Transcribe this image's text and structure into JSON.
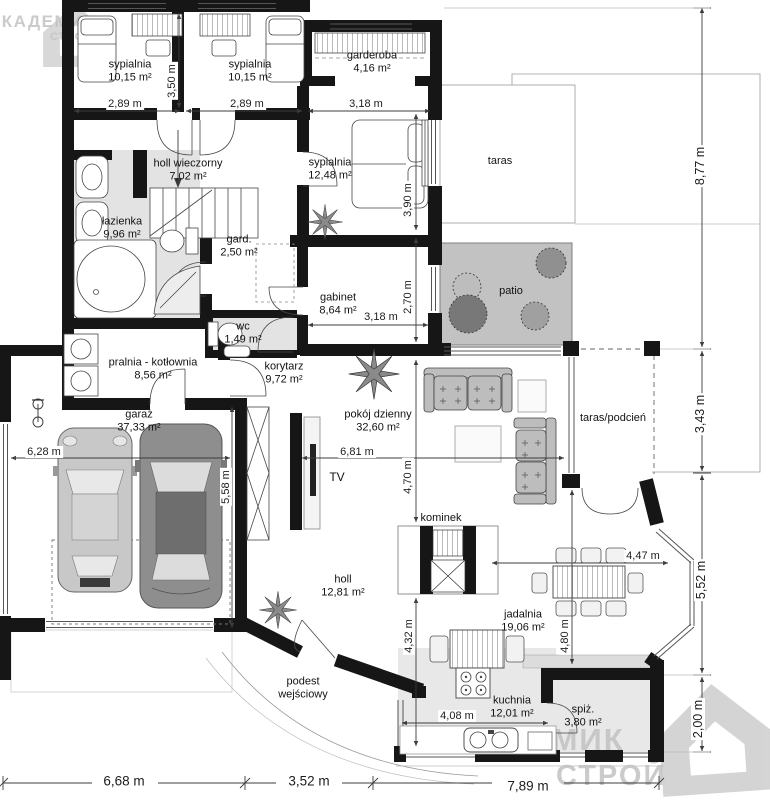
{
  "branding": {
    "watermark_line1": "АКАДЕМИК",
    "watermark_line2": "СТРОЙ"
  },
  "rooms": {
    "sypialnia_lewa": {
      "name": "sypialnia",
      "area": "10,15 m²"
    },
    "sypialnia_prawa": {
      "name": "sypialnia",
      "area": "10,15 m²"
    },
    "garderoba": {
      "name": "garderoba",
      "area": "4,16 m²"
    },
    "sypialnia_glowna": {
      "name": "sypialnia",
      "area": "12,48 m²"
    },
    "holl_wieczorny": {
      "name": "holl wieczorny",
      "area": "7,02 m²"
    },
    "lazienka": {
      "name": "łazienka",
      "area": "9,96 m²"
    },
    "gard": {
      "name": "gard.",
      "area": "2,50 m²"
    },
    "gabinet": {
      "name": "gabinet",
      "area": "8,64 m²"
    },
    "wc": {
      "name": "wc",
      "area": "1,49 m²"
    },
    "pralnia_kotlownia": {
      "name": "pralnia - kotłownia",
      "area": "8,56 m²"
    },
    "korytarz": {
      "name": "korytarz",
      "area": "9,72 m²"
    },
    "garaz": {
      "name": "garaż",
      "area": "37,33 m²"
    },
    "pokoj_dzienny": {
      "name": "pokój dzienny",
      "area": "32,60 m²"
    },
    "holl": {
      "name": "holl",
      "area": "12,81 m²"
    },
    "jadalnia": {
      "name": "jadalnia",
      "area": "19,06 m²"
    },
    "kuchnia": {
      "name": "kuchnia",
      "area": "12,01 m²"
    },
    "spiz": {
      "name": "spiż.",
      "area": "3,80 m²"
    }
  },
  "features": {
    "taras": "taras",
    "patio": "patio",
    "taras_podcien": "taras/podcień",
    "podest_line1": "podest",
    "podest_line2": "wejściowy",
    "kominek": "kominek",
    "tv": "TV"
  },
  "dimensions": {
    "sypialnia_lewa_szer": "2,89 m",
    "sypialnia_prawa_szer": "2,89 m",
    "sypialnie_gleb": "3,50 m",
    "sypialnia_glowna_szer": "3,18 m",
    "sypialnia_glowna_gleb": "3,90 m",
    "gabinet_szer": "3,18 m",
    "gabinet_gleb": "2,70 m",
    "garaz_szer": "6,28 m",
    "garaz_gleb": "5,58 m",
    "pokoj_szer": "6,81 m",
    "pokoj_gleb": "4,70 m",
    "holl_gleb": "4,32 m",
    "jadalnia_szer": "4,47 m",
    "jadalnia_gleb": "4,80 m",
    "kuchnia_szer": "4,08 m",
    "prawa_1": "8,77 m",
    "prawa_2": "3,43 m",
    "prawa_3": "5,52 m",
    "prawa_4": "2,00 m",
    "dol_1": "6,68 m",
    "dol_2": "3,52 m",
    "dol_3": "7,89 m"
  }
}
